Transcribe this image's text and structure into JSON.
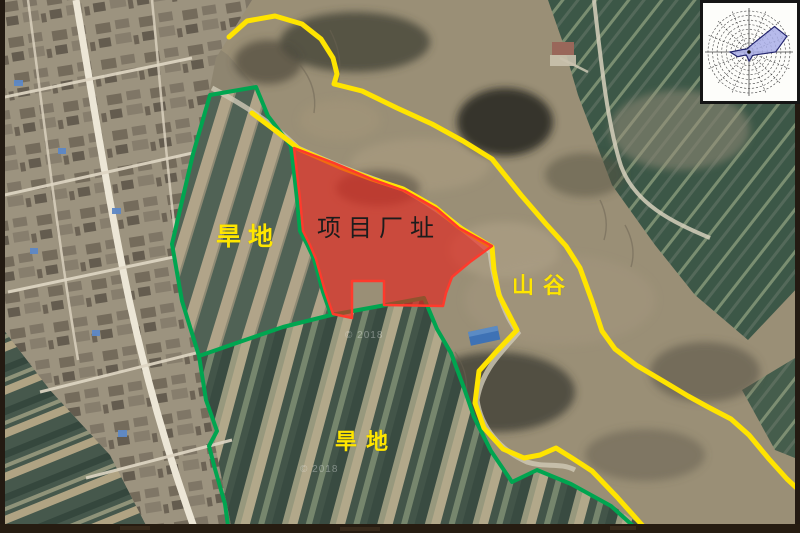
{
  "map": {
    "labels": {
      "dryland_north": "旱地",
      "project_site": "项目厂址",
      "valley": "山谷",
      "dryland_south": "旱地"
    },
    "watermark": "© 2018",
    "colors": {
      "project_site_fill": "#e8201a",
      "project_site_border": "#ff3a2c",
      "land_boundary_green": "#00a550",
      "valley_boundary_yellow": "#ffe400",
      "label_yellow": "#ffe600",
      "label_dark": "#1c1c1c"
    }
  },
  "wind_rose": {
    "type": "wind-rose",
    "directions": 16,
    "rings": 9,
    "radii_fraction": [
      0.12,
      0.2,
      0.88,
      1.0,
      0.65,
      0.18,
      0.12,
      0.15,
      0.22,
      0.12,
      0.1,
      0.3,
      0.46,
      0.16,
      0.1,
      0.09
    ],
    "fill": "#a9aee8",
    "outline": "#23256e"
  }
}
